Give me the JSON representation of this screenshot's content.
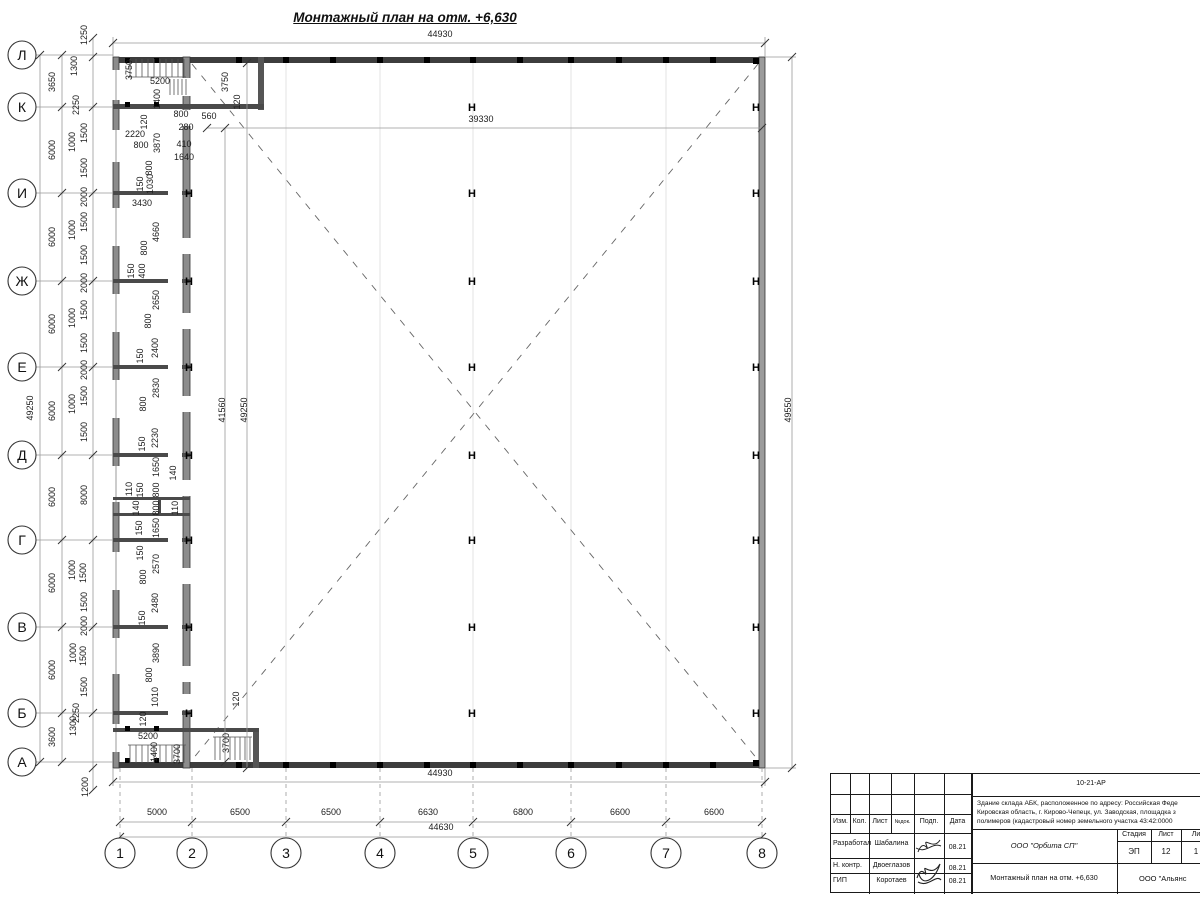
{
  "title": "Монтажный план на отм. +6,630",
  "colors": {
    "wall_dark": "#3d3d3d",
    "wall_grey": "#8c8c8c",
    "dim_line": "#999999",
    "line": "#1a1a1a"
  },
  "axes": {
    "rows": [
      {
        "label": "Л",
        "y": 55
      },
      {
        "label": "К",
        "y": 107
      },
      {
        "label": "И",
        "y": 193
      },
      {
        "label": "Ж",
        "y": 281
      },
      {
        "label": "Е",
        "y": 367
      },
      {
        "label": "Д",
        "y": 455
      },
      {
        "label": "Г",
        "y": 540
      },
      {
        "label": "В",
        "y": 627
      },
      {
        "label": "Б",
        "y": 713
      },
      {
        "label": "А",
        "y": 762
      }
    ],
    "cols": [
      {
        "label": "1",
        "x": 120
      },
      {
        "label": "2",
        "x": 192
      },
      {
        "label": "3",
        "x": 286
      },
      {
        "label": "4",
        "x": 380
      },
      {
        "label": "5",
        "x": 473
      },
      {
        "label": "6",
        "x": 571
      },
      {
        "label": "7",
        "x": 666
      },
      {
        "label": "8",
        "x": 762
      }
    ]
  },
  "hmarks": {
    "glyph": "Н",
    "groups": [
      {
        "x": 189,
        "ys": [
          193,
          281,
          367,
          455,
          540,
          627,
          713
        ]
      },
      {
        "x": 472,
        "ys": [
          107,
          193,
          281,
          367,
          455,
          540,
          627,
          713
        ]
      },
      {
        "x": 756,
        "ys": [
          107,
          193,
          281,
          367,
          455,
          540,
          627,
          713
        ]
      }
    ]
  },
  "dims": [
    [
      "44930",
      440,
      37,
      0
    ],
    [
      "39330",
      481,
      122,
      0
    ],
    [
      "560",
      209,
      119,
      0
    ],
    [
      "3750",
      132,
      70,
      1
    ],
    [
      "5200",
      160,
      84,
      0
    ],
    [
      "1400",
      160,
      99,
      1
    ],
    [
      "120",
      147,
      122,
      1
    ],
    [
      "800",
      181,
      117,
      0
    ],
    [
      "280",
      186,
      130,
      0
    ],
    [
      "2220",
      135,
      137,
      0
    ],
    [
      "800",
      141,
      148,
      0
    ],
    [
      "3870",
      160,
      143,
      1
    ],
    [
      "410",
      184,
      147,
      0
    ],
    [
      "1640",
      184,
      160,
      0
    ],
    [
      "800",
      152,
      168,
      1
    ],
    [
      "3750",
      228,
      82,
      1
    ],
    [
      "120",
      240,
      102,
      1
    ],
    [
      "150",
      143,
      184,
      1
    ],
    [
      "1030",
      153,
      184,
      1
    ],
    [
      "3430",
      142,
      206,
      0
    ],
    [
      "4660",
      159,
      232,
      1
    ],
    [
      "800",
      147,
      248,
      1
    ],
    [
      "400",
      145,
      271,
      1
    ],
    [
      "150",
      134,
      271,
      1
    ],
    [
      "2650",
      159,
      300,
      1
    ],
    [
      "800",
      151,
      321,
      1
    ],
    [
      "2400",
      158,
      348,
      1
    ],
    [
      "150",
      143,
      356,
      1
    ],
    [
      "2830",
      159,
      388,
      1
    ],
    [
      "800",
      146,
      404,
      1
    ],
    [
      "2230",
      158,
      438,
      1
    ],
    [
      "150",
      145,
      444,
      1
    ],
    [
      "1650",
      159,
      467,
      1
    ],
    [
      "140",
      176,
      473,
      1
    ],
    [
      "110",
      132,
      489,
      1
    ],
    [
      "150",
      143,
      490,
      1
    ],
    [
      "800",
      159,
      490,
      1
    ],
    [
      "140",
      139,
      508,
      1
    ],
    [
      "800",
      159,
      508,
      1
    ],
    [
      "110",
      178,
      508,
      1
    ],
    [
      "150",
      142,
      528,
      1
    ],
    [
      "1650",
      159,
      528,
      1
    ],
    [
      "150",
      143,
      553,
      1
    ],
    [
      "2570",
      159,
      564,
      1
    ],
    [
      "800",
      146,
      577,
      1
    ],
    [
      "2480",
      158,
      603,
      1
    ],
    [
      "150",
      145,
      618,
      1
    ],
    [
      "3890",
      159,
      653,
      1
    ],
    [
      "800",
      152,
      675,
      1
    ],
    [
      "1010",
      158,
      697,
      1
    ],
    [
      "120",
      146,
      719,
      1
    ],
    [
      "5200",
      148,
      739,
      0
    ],
    [
      "1400",
      157,
      752,
      1
    ],
    [
      "3700",
      180,
      754,
      1
    ],
    [
      "120",
      239,
      699,
      1
    ],
    [
      "3700",
      229,
      743,
      1
    ],
    [
      "41560",
      225,
      410,
      1
    ],
    [
      "49250",
      247,
      410,
      1
    ],
    [
      "49550",
      791,
      410,
      1
    ],
    [
      "49250",
      33,
      408,
      1
    ],
    [
      "3650",
      55,
      82,
      1
    ],
    [
      "6000",
      55,
      150,
      1
    ],
    [
      "6000",
      55,
      237,
      1
    ],
    [
      "6000",
      55,
      324,
      1
    ],
    [
      "6000",
      55,
      411,
      1
    ],
    [
      "6000",
      55,
      497,
      1
    ],
    [
      "6000",
      55,
      583,
      1
    ],
    [
      "6000",
      55,
      670,
      1
    ],
    [
      "3600",
      55,
      737,
      1
    ],
    [
      "1250",
      87,
      35,
      1
    ],
    [
      "1300",
      77,
      66,
      1
    ],
    [
      "2250",
      79,
      105,
      1
    ],
    [
      "1500",
      87,
      133,
      1
    ],
    [
      "1000",
      75,
      142,
      1
    ],
    [
      "1500",
      87,
      168,
      1
    ],
    [
      "2000",
      87,
      197,
      1
    ],
    [
      "1500",
      87,
      222,
      1
    ],
    [
      "1000",
      75,
      230,
      1
    ],
    [
      "1500",
      87,
      255,
      1
    ],
    [
      "2000",
      87,
      283,
      1
    ],
    [
      "1500",
      87,
      310,
      1
    ],
    [
      "1000",
      75,
      318,
      1
    ],
    [
      "1500",
      87,
      343,
      1
    ],
    [
      "2000",
      87,
      370,
      1
    ],
    [
      "1500",
      87,
      396,
      1
    ],
    [
      "1000",
      75,
      404,
      1
    ],
    [
      "1500",
      87,
      432,
      1
    ],
    [
      "8000",
      87,
      495,
      1
    ],
    [
      "1000",
      75,
      570,
      1
    ],
    [
      "1500",
      86,
      573,
      1
    ],
    [
      "1500",
      87,
      602,
      1
    ],
    [
      "2000",
      87,
      626,
      1
    ],
    [
      "1000",
      76,
      653,
      1
    ],
    [
      "1500",
      86,
      656,
      1
    ],
    [
      "1500",
      87,
      687,
      1
    ],
    [
      "2250",
      79,
      713,
      1
    ],
    [
      "1300",
      76,
      726,
      1
    ],
    [
      "1200",
      88,
      787,
      1
    ],
    [
      "44930",
      440,
      776,
      0
    ],
    [
      "5000",
      157,
      815,
      0
    ],
    [
      "6500",
      240,
      815,
      0
    ],
    [
      "6500",
      331,
      815,
      0
    ],
    [
      "6630",
      428,
      815,
      0
    ],
    [
      "6800",
      523,
      815,
      0
    ],
    [
      "6600",
      620,
      815,
      0
    ],
    [
      "6600",
      714,
      815,
      0
    ],
    [
      "44630",
      441,
      830,
      0
    ]
  ],
  "title_block": {
    "code": "10-21-АР",
    "desc1": "Здание склада АБК, расположенное по адресу: Российская Феде",
    "desc2": "Кировская область, г. Кирово-Чепецк, ул. Заводская, площадка з",
    "desc3": "полимеров (кадастровый номер земельного участка 43:42:0000",
    "org": "ООО \"Орбита СП\"",
    "doc": "Монтажный план на отм. +6,630",
    "firm": "ООО \"Альянс",
    "stage_label": "Стадия",
    "sheet_label": "Лист",
    "sheets_label": "Ли",
    "stage": "ЭП",
    "sheet": "12",
    "sheets": "1",
    "cols": [
      "Изм.",
      "Кол.",
      "Лист",
      "№док.",
      "Подп.",
      "Дата"
    ],
    "rows": [
      {
        "role": "Разработал",
        "name": "Шабалина",
        "date": "08.21"
      },
      {
        "role": "Н. контр.",
        "name": "Двоеглазов",
        "date": "08.21"
      },
      {
        "role": "ГИП",
        "name": "Коротаев",
        "date": "08.21"
      }
    ]
  }
}
